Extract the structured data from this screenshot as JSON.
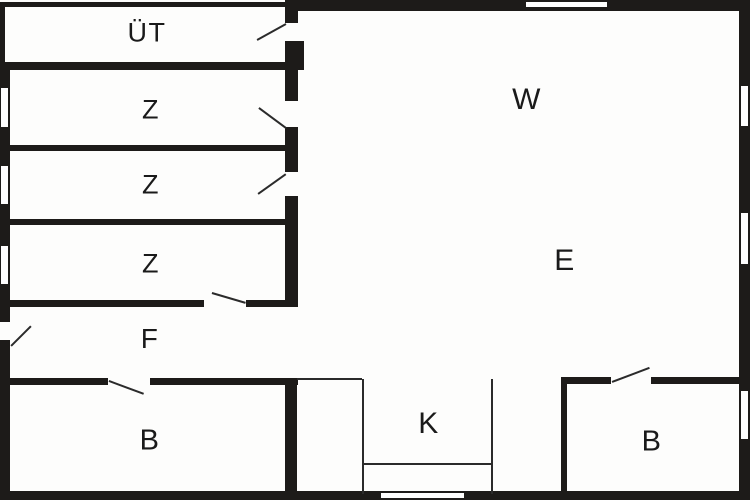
{
  "plan": {
    "title": "floor-plan",
    "canvas": {
      "width": 750,
      "height": 500,
      "floor_color": "#fdfdfc",
      "wall_color": "#1d1b19",
      "line_color": "#2b2b2b",
      "label_color": "#1a1a1a"
    },
    "rooms": [
      {
        "id": "uet",
        "label": "ÜT",
        "x": 147,
        "y": 33,
        "font": 27
      },
      {
        "id": "z1",
        "label": "Z",
        "x": 151,
        "y": 110,
        "font": 27
      },
      {
        "id": "z2",
        "label": "Z",
        "x": 151,
        "y": 185,
        "font": 27
      },
      {
        "id": "z3",
        "label": "Z",
        "x": 151,
        "y": 264,
        "font": 27
      },
      {
        "id": "f",
        "label": "F",
        "x": 150,
        "y": 339,
        "font": 28
      },
      {
        "id": "b-left",
        "label": "B",
        "x": 150,
        "y": 441,
        "font": 29
      },
      {
        "id": "w",
        "label": "W",
        "x": 527,
        "y": 100,
        "font": 30
      },
      {
        "id": "e",
        "label": "E",
        "x": 565,
        "y": 261,
        "font": 30
      },
      {
        "id": "k",
        "label": "K",
        "x": 429,
        "y": 424,
        "font": 30
      },
      {
        "id": "b-right",
        "label": "B",
        "x": 652,
        "y": 442,
        "font": 29
      }
    ],
    "walls": [
      {
        "x": 0,
        "y": 2,
        "w": 287,
        "h": 5
      },
      {
        "x": 0,
        "y": 2,
        "w": 5,
        "h": 62
      },
      {
        "x": 286,
        "y": 0,
        "w": 464,
        "h": 11
      },
      {
        "x": 739,
        "y": 0,
        "w": 11,
        "h": 500
      },
      {
        "x": 0,
        "y": 491,
        "w": 750,
        "h": 9
      },
      {
        "x": 0,
        "y": 62,
        "w": 10,
        "h": 438
      },
      {
        "x": 0,
        "y": 62,
        "w": 298,
        "h": 8
      },
      {
        "x": 10,
        "y": 145,
        "w": 288,
        "h": 6
      },
      {
        "x": 10,
        "y": 219,
        "w": 288,
        "h": 6
      },
      {
        "x": 10,
        "y": 300,
        "w": 288,
        "h": 7
      },
      {
        "x": 10,
        "y": 378,
        "w": 288,
        "h": 7
      },
      {
        "x": 285,
        "y": 0,
        "w": 13,
        "h": 307
      },
      {
        "x": 297,
        "y": 41,
        "w": 7,
        "h": 29
      },
      {
        "x": 285,
        "y": 378,
        "w": 12,
        "h": 122
      },
      {
        "x": 561,
        "y": 378,
        "w": 6,
        "h": 122
      },
      {
        "x": 561,
        "y": 377,
        "w": 178,
        "h": 7
      }
    ],
    "windows": [
      {
        "x": 0,
        "y": 87,
        "w": 9,
        "h": 41
      },
      {
        "x": 0,
        "y": 165,
        "w": 9,
        "h": 40
      },
      {
        "x": 0,
        "y": 245,
        "w": 9,
        "h": 40
      },
      {
        "x": 740,
        "y": 85,
        "w": 9,
        "h": 42
      },
      {
        "x": 740,
        "y": 212,
        "w": 9,
        "h": 53
      },
      {
        "x": 740,
        "y": 390,
        "w": 9,
        "h": 50
      },
      {
        "x": 525,
        "y": 1,
        "w": 83,
        "h": 7
      },
      {
        "x": 380,
        "y": 492,
        "w": 85,
        "h": 7
      }
    ],
    "door_openings": [
      {
        "x": 285,
        "y": 23,
        "w": 13,
        "h": 18
      },
      {
        "x": 285,
        "y": 101,
        "w": 13,
        "h": 26
      },
      {
        "x": 285,
        "y": 172,
        "w": 13,
        "h": 24
      },
      {
        "x": 204,
        "y": 300,
        "w": 42,
        "h": 7
      },
      {
        "x": 0,
        "y": 322,
        "w": 10,
        "h": 18
      },
      {
        "x": 108,
        "y": 378,
        "w": 42,
        "h": 7
      },
      {
        "x": 611,
        "y": 377,
        "w": 40,
        "h": 7
      }
    ],
    "door_swings": [
      {
        "x1": 257,
        "y1": 39,
        "x2": 286,
        "y2": 23
      },
      {
        "x1": 259,
        "y1": 107,
        "x2": 286,
        "y2": 127
      },
      {
        "x1": 258,
        "y1": 193,
        "x2": 286,
        "y2": 173
      },
      {
        "x1": 212,
        "y1": 292,
        "x2": 246,
        "y2": 302
      },
      {
        "x1": 11,
        "y1": 345,
        "x2": 31,
        "y2": 325
      },
      {
        "x1": 109,
        "y1": 380,
        "x2": 144,
        "y2": 393
      },
      {
        "x1": 612,
        "y1": 381,
        "x2": 649,
        "y2": 367
      }
    ],
    "thin_lines": [
      {
        "x": 297,
        "y": 378,
        "w": 65,
        "h": 2
      },
      {
        "x": 362,
        "y": 379,
        "w": 2,
        "h": 115
      },
      {
        "x": 491,
        "y": 379,
        "w": 2,
        "h": 115
      },
      {
        "x": 362,
        "y": 463,
        "w": 130,
        "h": 2
      }
    ]
  }
}
